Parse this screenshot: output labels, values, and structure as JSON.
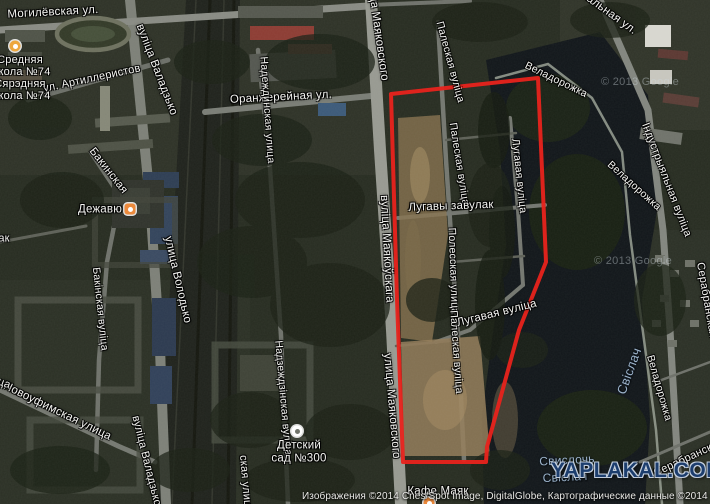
{
  "meta": {
    "description": "Satellite map view of Minsk riverside district with red boundary overlay",
    "width": 710,
    "height": 504
  },
  "overlay": {
    "polygon_color": "#e8231c",
    "polygon_width": 4,
    "polygon_points": [
      [
        391,
        94
      ],
      [
        538,
        78
      ],
      [
        546,
        262
      ],
      [
        519,
        330
      ],
      [
        487,
        447
      ],
      [
        486,
        462
      ],
      [
        403,
        462
      ],
      [
        397,
        300
      ]
    ]
  },
  "watermarks": {
    "yaplakal": {
      "text": "YAPLAKAL.COM",
      "color": "#1d3e6e"
    },
    "google_tiles": [
      {
        "text": "© 2013 Google",
        "x": 640,
        "y": 82
      },
      {
        "text": "© 2013 Google",
        "x": 633,
        "y": 261
      }
    ],
    "attribution": "Изображения ©2014 Cnes/Spot Image, DigitalGlobe, Картографические данные ©2014 Google"
  },
  "map": {
    "street_label_color": "#f4f4f1",
    "water_label_color": "#9db3ca",
    "street_labels": [
      {
        "text": "Могилёвская ул.",
        "x": 53,
        "y": 13,
        "rot": -3,
        "size": 11.5
      },
      {
        "text": "ул. Артиллеристов",
        "x": 92,
        "y": 79,
        "rot": -12,
        "size": 11
      },
      {
        "text": "вуліца Валадзько",
        "x": 156,
        "y": 70,
        "rot": 69,
        "size": 11.5
      },
      {
        "text": "Оранжерейная ул.",
        "x": 281,
        "y": 98,
        "rot": -3,
        "size": 11.5
      },
      {
        "text": "ца Маяковского",
        "x": 378,
        "y": 38,
        "rot": 82,
        "size": 11.5
      },
      {
        "text": "Палеская вуліца",
        "x": 450,
        "y": 62,
        "rot": 75,
        "size": 10.5
      },
      {
        "text": "Палеская вуліца",
        "x": 459,
        "y": 164,
        "rot": 81,
        "size": 10.5
      },
      {
        "text": "вуліца Маякоўскага",
        "x": 386,
        "y": 249,
        "rot": 87,
        "size": 11.5
      },
      {
        "text": "Лугавы завулак",
        "x": 451,
        "y": 207,
        "rot": -2,
        "size": 11.5
      },
      {
        "text": "Лугавая вуліца",
        "x": 519,
        "y": 176,
        "rot": 84,
        "size": 10.5
      },
      {
        "text": "Полесская улица",
        "x": 453,
        "y": 271,
        "rot": 88,
        "size": 10.5
      },
      {
        "text": "Палеская вуліца",
        "x": 456,
        "y": 352,
        "rot": 86,
        "size": 10.5
      },
      {
        "text": "Лугавая вуліца",
        "x": 497,
        "y": 314,
        "rot": -14,
        "size": 11.5
      },
      {
        "text": "улица Маяковского",
        "x": 391,
        "y": 406,
        "rot": 85,
        "size": 11.5
      },
      {
        "text": "Бакинская",
        "x": 108,
        "y": 171,
        "rot": 52,
        "size": 11
      },
      {
        "text": "Бакінская вуліца",
        "x": 100,
        "y": 309,
        "rot": 84,
        "size": 10.5
      },
      {
        "text": "улица Володько",
        "x": 177,
        "y": 280,
        "rot": 77,
        "size": 11.5
      },
      {
        "text": "вуліца Валадзько",
        "x": 146,
        "y": 461,
        "rot": 76,
        "size": 11
      },
      {
        "text": "Новоуфимская улица",
        "x": 57,
        "y": 412,
        "rot": 26,
        "size": 11.5
      },
      {
        "text": "Надеждинская улица",
        "x": 267,
        "y": 110,
        "rot": 86,
        "size": 10.5
      },
      {
        "text": "Надзеждзінская вуліца",
        "x": 283,
        "y": 398,
        "rot": 85,
        "size": 10.5
      },
      {
        "text": "ская улица",
        "x": 245,
        "y": 484,
        "rot": 85,
        "size": 11
      },
      {
        "text": "Веладорожка",
        "x": 556,
        "y": 80,
        "rot": 26,
        "size": 10.5
      },
      {
        "text": "Веладорожка",
        "x": 634,
        "y": 186,
        "rot": 42,
        "size": 10.5
      },
      {
        "text": "Веладорожка",
        "x": 659,
        "y": 388,
        "rot": 74,
        "size": 10.5
      },
      {
        "text": "Индустриальная ул.",
        "x": 590,
        "y": 0,
        "rot": 36,
        "size": 11.5
      },
      {
        "text": "Індустрыяльная вуліца",
        "x": 666,
        "y": 180,
        "rot": 69,
        "size": 11
      },
      {
        "text": "Серабранская",
        "x": 689,
        "y": 458,
        "rot": -25,
        "size": 11
      },
      {
        "text": "Серабранская",
        "x": 706,
        "y": 300,
        "rot": 80,
        "size": 11
      },
      {
        "text": "ца",
        "x": 4,
        "y": 384,
        "rot": 20,
        "size": 11
      },
      {
        "text": "ак",
        "x": 4,
        "y": 239,
        "rot": 0,
        "size": 11
      }
    ],
    "water_labels": [
      {
        "text": "Свіслач",
        "x": 629,
        "y": 371,
        "rot": -70,
        "size": 13
      },
      {
        "text": "Свислочь",
        "x": 567,
        "y": 460,
        "rot": -3,
        "size": 12
      },
      {
        "text": "Свіслач",
        "x": 565,
        "y": 477,
        "rot": -3,
        "size": 12
      }
    ],
    "pois": [
      {
        "name": "Средняя школа №74",
        "lines": [
          "Средняя",
          "школа №74",
          "Сярэдняя",
          "школа №74"
        ],
        "icon": "school",
        "icon_color": "#eda73e",
        "x": 15,
        "y": 46,
        "text_x": 20,
        "text_y": 78,
        "size": 11
      },
      {
        "name": "Дежавю",
        "lines": [
          "Дежавю"
        ],
        "icon": "restaurant",
        "icon_color": "#ec8a3c",
        "x": 130,
        "y": 209,
        "text_x": 100,
        "text_y": 210,
        "size": 11.5
      },
      {
        "name": "Детский сад №300",
        "lines": [
          "Детский",
          "сад №300"
        ],
        "icon": "kindergarten",
        "icon_color": "#ffffff",
        "x": 297,
        "y": 431,
        "text_x": 299,
        "text_y": 452,
        "size": 11.5
      },
      {
        "name": "Кафе Маяк",
        "lines": [
          "Кафе Маяк"
        ],
        "icon": "cafe",
        "icon_color": "#ec8a3c",
        "x": 429,
        "y": 503,
        "text_x": 438,
        "text_y": 492,
        "size": 11.5
      }
    ]
  }
}
